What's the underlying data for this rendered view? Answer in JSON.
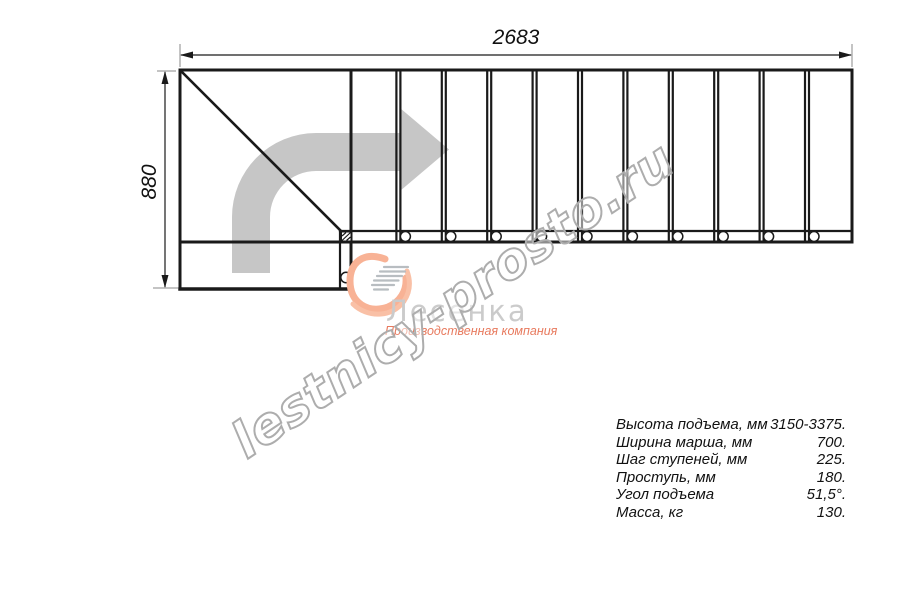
{
  "drawing": {
    "dimension_width": "2683",
    "dimension_height": "880"
  },
  "watermark": {
    "text": "lestnicy-prosto.ru"
  },
  "logo": {
    "title": "Лесенка",
    "subtitle": "Производственная компания"
  },
  "specs": {
    "rows": [
      {
        "label": "Высота подъема, мм",
        "value": "3150-3375."
      },
      {
        "label": "Ширина марша, мм",
        "value": "700."
      },
      {
        "label": "Шаг ступеней, мм",
        "value": "225."
      },
      {
        "label": "Проступь, мм",
        "value": "180."
      },
      {
        "label": "Угол подъема",
        "value": "51,5°."
      },
      {
        "label": "Масса, кг",
        "value": "130."
      }
    ]
  },
  "colors": {
    "line_black": "#1a1a1a",
    "arrow_gray": "#c6c6c6",
    "watermark_gray": "#adadad",
    "logo_gray": "#cbcbcb",
    "logo_orange": "#f8b295",
    "subtitle_red": "#e87a5e"
  }
}
